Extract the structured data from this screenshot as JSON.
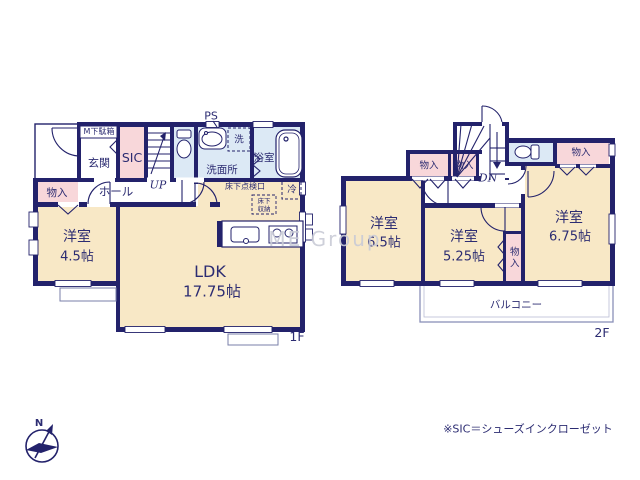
{
  "watermark": {
    "text": "ME Group"
  },
  "footnote": {
    "text": "※SIC＝シューズインクローゼット"
  },
  "compass": {
    "north_label": "N"
  },
  "colors": {
    "wall": "#23226b",
    "room_cream": "#f8e8c6",
    "room_pink": "#f8d7da",
    "room_blue": "#dce9f5",
    "text": "#2c2c72",
    "watermark": "#c9cbd6",
    "balcony_border": "#8a90b8"
  },
  "icons": {
    "compass": "compass-icon",
    "toilet": "toilet-icon",
    "bathtub": "bathtub-icon",
    "washbasin": "washbasin-icon",
    "kitchen_sink": "kitchen-sink-icon",
    "stove": "stove-icon"
  },
  "floor1": {
    "label": "1F",
    "entrance": "玄関",
    "shoe_box": "M下駄箱",
    "shoe_closet": "SIC",
    "stairs": "UP",
    "pipe_space": "PS",
    "washroom": "洗面所",
    "washer": "洗",
    "bathroom": "浴室",
    "hall": "ホール",
    "closet": "物入",
    "underfloor_hatch": "床下点検口",
    "underfloor_storage_line1": "床下",
    "underfloor_storage_line2": "収納",
    "fridge": "冷",
    "western_room": {
      "name": "洋室",
      "size": "4.5帖"
    },
    "ldk": {
      "name": "LDK",
      "size": "17.75帖"
    }
  },
  "floor2": {
    "label": "2F",
    "stairs": "DN",
    "closet_left1": "物入",
    "closet_left2": "物入",
    "closet_top_right": "物入",
    "closet_middle": "物入",
    "western_room_a": {
      "name": "洋室",
      "size": "6.5帖"
    },
    "western_room_b": {
      "name": "洋室",
      "size": "5.25帖"
    },
    "western_room_c": {
      "name": "洋室",
      "size": "6.75帖"
    },
    "balcony": "バルコニー"
  }
}
